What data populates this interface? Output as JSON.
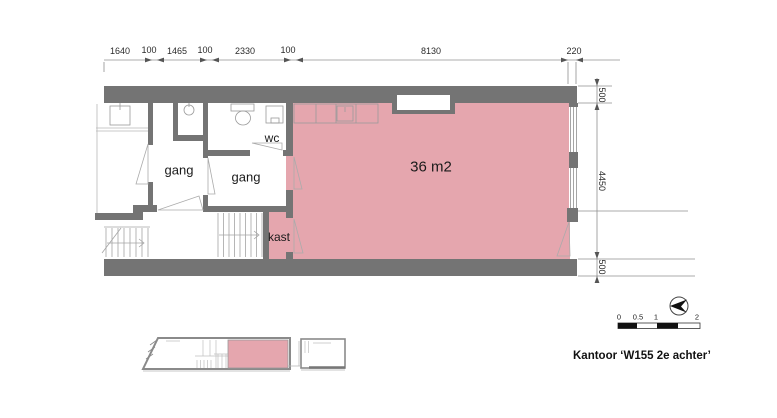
{
  "title": "Kantoor ‘W155 2e achter’",
  "plan": {
    "area_label": "36 m2",
    "room_labels": {
      "wc": "wc",
      "gang_left": "gang",
      "gang_right": "gang",
      "kast": "kast"
    }
  },
  "dimensions": {
    "top": [
      "1640",
      "100",
      "1465",
      "100",
      "2330",
      "100",
      "8130",
      "220"
    ],
    "right": [
      "500",
      "4450",
      "500"
    ]
  },
  "scale_bar": {
    "labels": [
      "0",
      "0.5",
      "1",
      "2"
    ]
  },
  "legend": {
    "north_arrow": "north-arrow-icon"
  },
  "colors": {
    "room_fill": "#e5a6ae",
    "wall": "#747474"
  }
}
